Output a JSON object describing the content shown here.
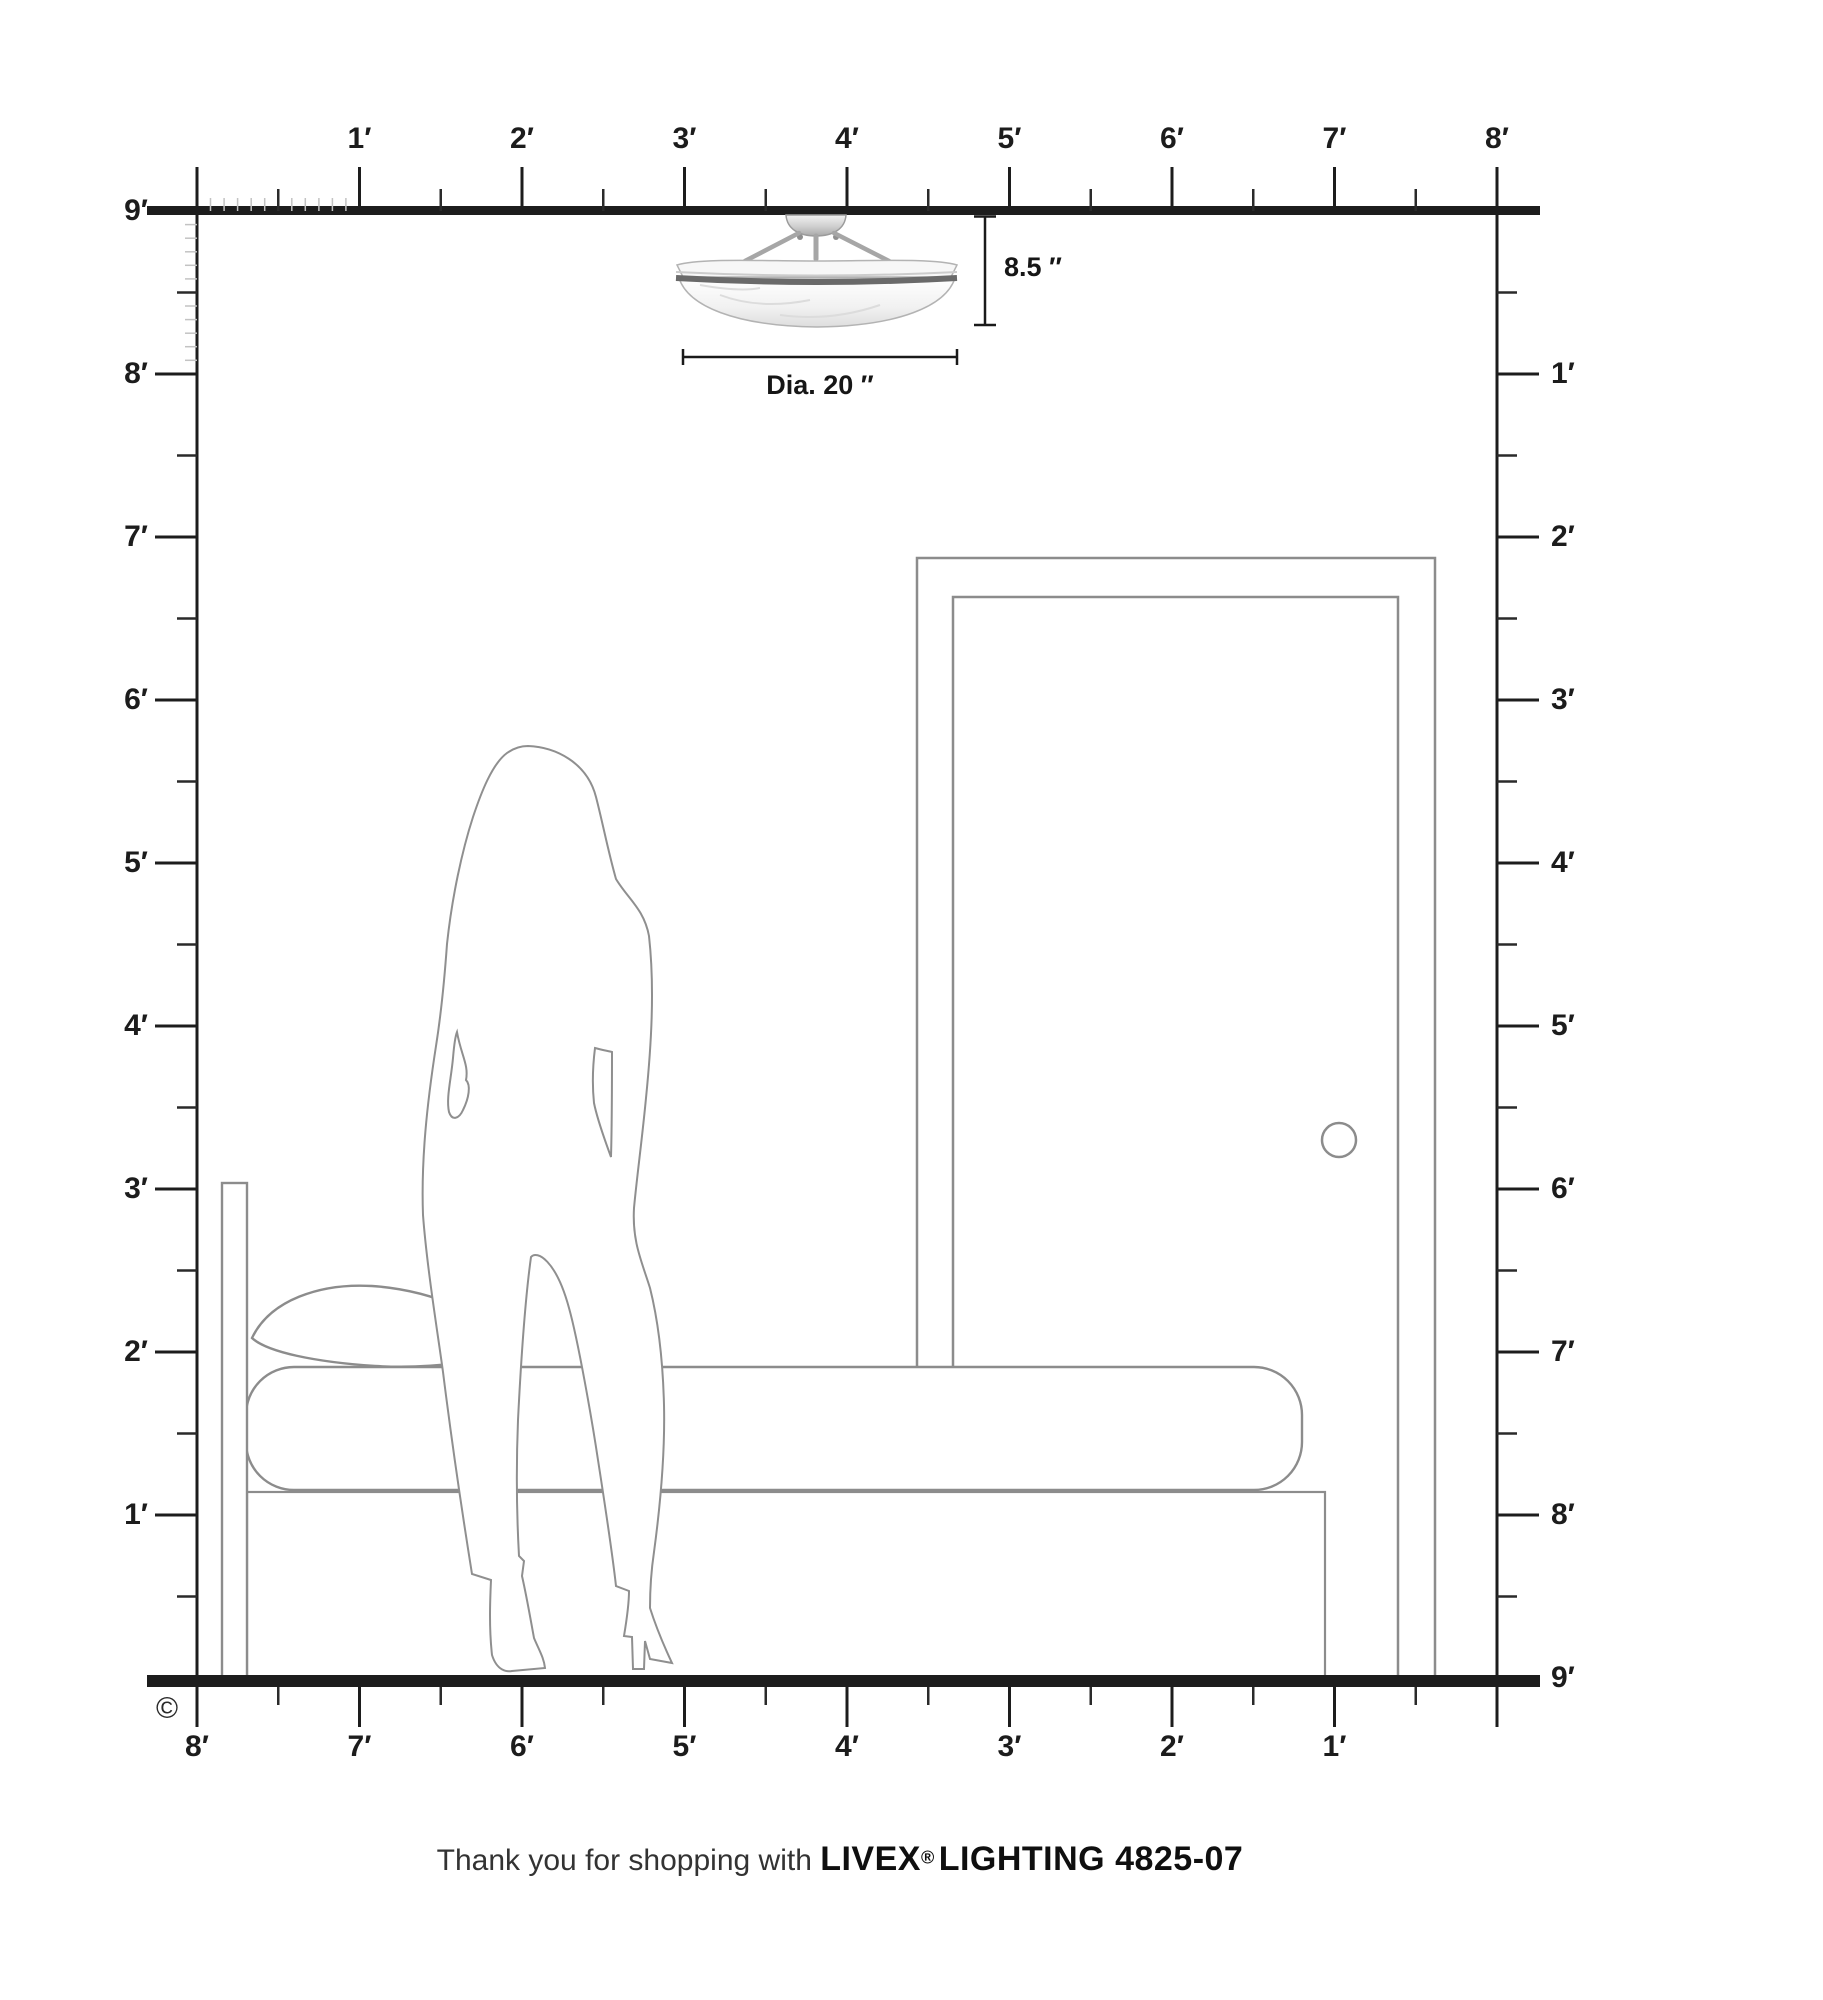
{
  "rulers": {
    "top": {
      "labels": [
        "1′",
        "2′",
        "3′",
        "4′",
        "5′",
        "6′",
        "7′",
        "8′"
      ]
    },
    "left": {
      "labels": [
        "9′",
        "8′",
        "7′",
        "6′",
        "5′",
        "4′",
        "3′",
        "2′",
        "1′"
      ]
    },
    "right": {
      "labels": [
        "1′",
        "2′",
        "3′",
        "4′",
        "5′",
        "6′",
        "7′",
        "8′",
        "9′"
      ]
    },
    "bottom": {
      "labels": [
        "8′",
        "7′",
        "6′",
        "5′",
        "4′",
        "3′",
        "2′",
        "1′"
      ]
    }
  },
  "fixture": {
    "type": "semi-flush ceiling light",
    "height_label": "8.5 ″",
    "diameter_label": "Dia. 20 ″"
  },
  "caption": {
    "prefix": "Thank you for shopping with ",
    "brand": "LIVEX",
    "registered": "®",
    "suffix": " LIGHTING 4825-07"
  },
  "copyright_symbol": "©",
  "scene": {
    "objects": [
      "ceiling-light-fixture",
      "door",
      "door-knob",
      "bed-headboard",
      "pillow",
      "mattress",
      "bed-base",
      "woman-silhouette"
    ],
    "room_height_feet": 9,
    "room_width_feet": 8
  },
  "colors": {
    "ink": "#1c1c1c",
    "outline_gray": "#8c8c8c",
    "minor_tick": "#c3c3c3",
    "fixture_band": "#6a6a6a"
  }
}
